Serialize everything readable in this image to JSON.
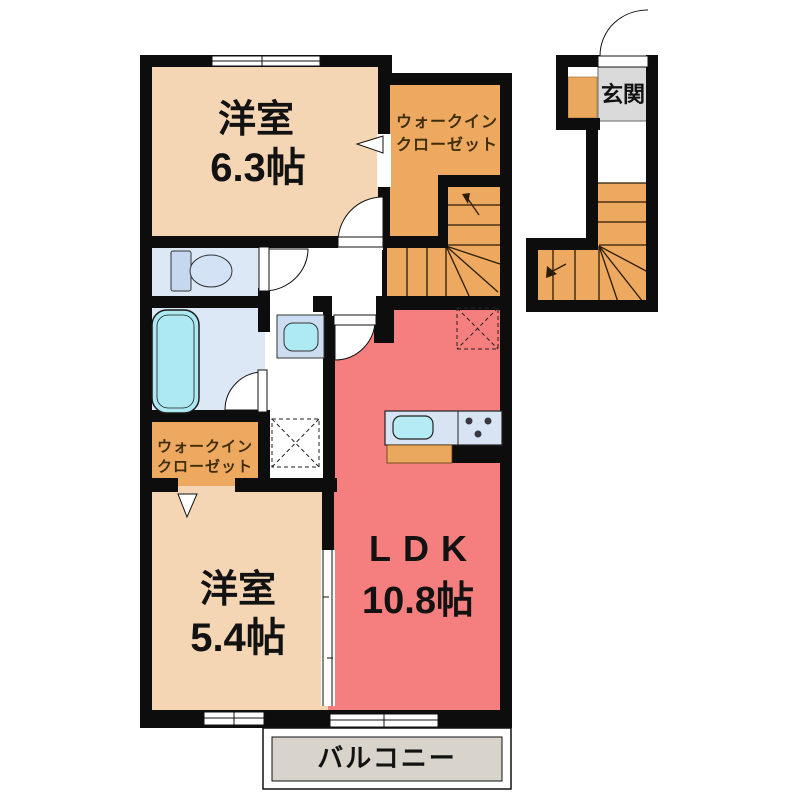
{
  "rooms": {
    "bedroom_upper": {
      "name": "洋室",
      "size": "6.3帖"
    },
    "walkin_closet_upper": {
      "name_line1": "ウォークイン",
      "name_line2": "クローゼット"
    },
    "entrance": {
      "name": "玄関"
    },
    "walkin_closet_lower": {
      "name_line1": "ウォークイン",
      "name_line2": "クローゼット"
    },
    "bedroom_lower": {
      "name": "洋室",
      "size": "5.4帖"
    },
    "ldk": {
      "name": "LDK",
      "size": "10.8帖"
    },
    "balcony": {
      "name": "バルコニー"
    }
  },
  "colors": {
    "bedroom_peach": "#f5d6b4",
    "closet_stairs_orange": "#eca95f",
    "ldk_red": "#f57f7f",
    "sanitary_blue": "#dde8f7",
    "bathtub_cyan": "#ade9f2",
    "kitchen_counter_blue": "#d8e4f3",
    "balcony_gray": "#d8d4cc",
    "entrance_tile_gray": "#dadada",
    "wall_black": "#0d0d0d"
  }
}
